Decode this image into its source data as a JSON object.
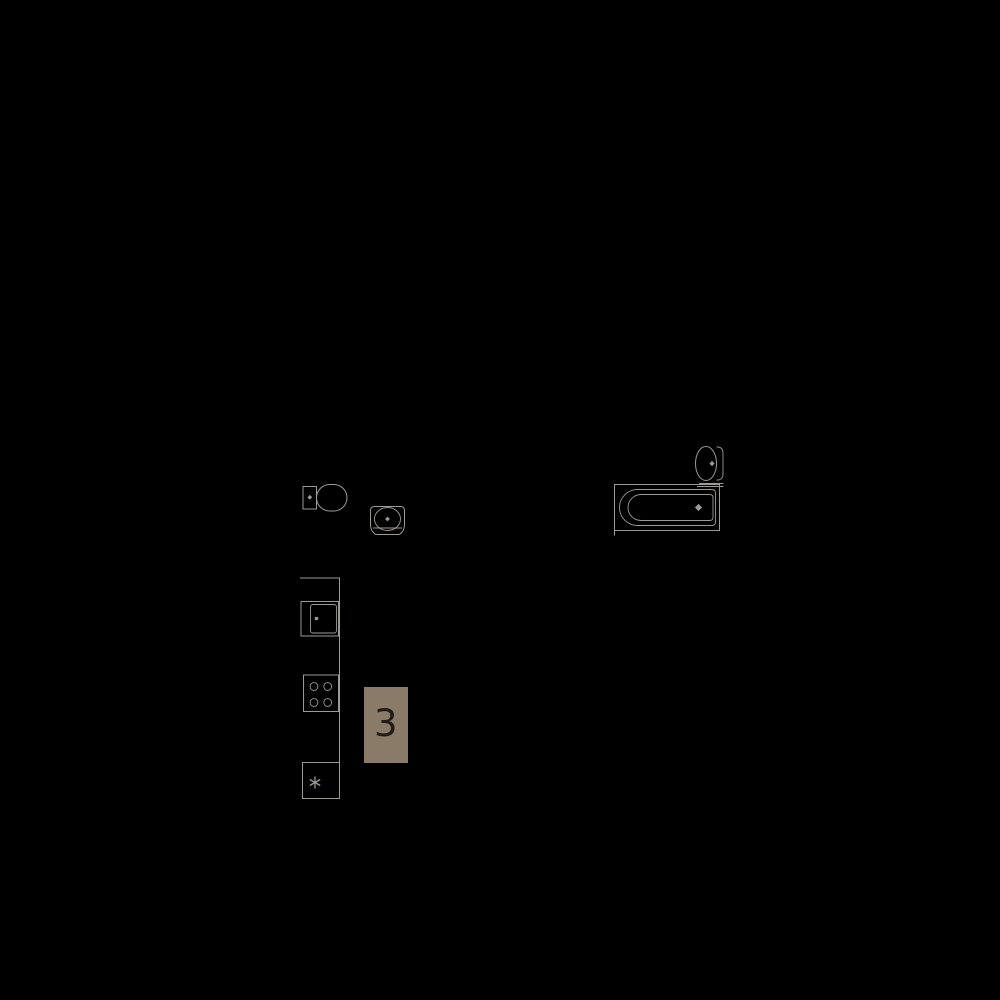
{
  "canvas": {
    "width": 1000,
    "height": 1000,
    "background_color": "#000000",
    "line_color": "#9c9a96"
  },
  "floor_plan": {
    "description": "apartment floor plan fragment on black background",
    "fixtures": [
      {
        "name": "toilet-icon"
      },
      {
        "name": "washbasin-icon"
      },
      {
        "name": "bathtub-icon"
      },
      {
        "name": "pedestal-sink-icon"
      },
      {
        "name": "kitchen-counter-line"
      },
      {
        "name": "kitchen-sink-icon"
      },
      {
        "name": "cooktop-icon"
      },
      {
        "name": "fridge-freezer-icon"
      }
    ]
  },
  "unit_label": {
    "text": "3",
    "bg_color": "#8a7a68",
    "text_color": "#201c16"
  }
}
